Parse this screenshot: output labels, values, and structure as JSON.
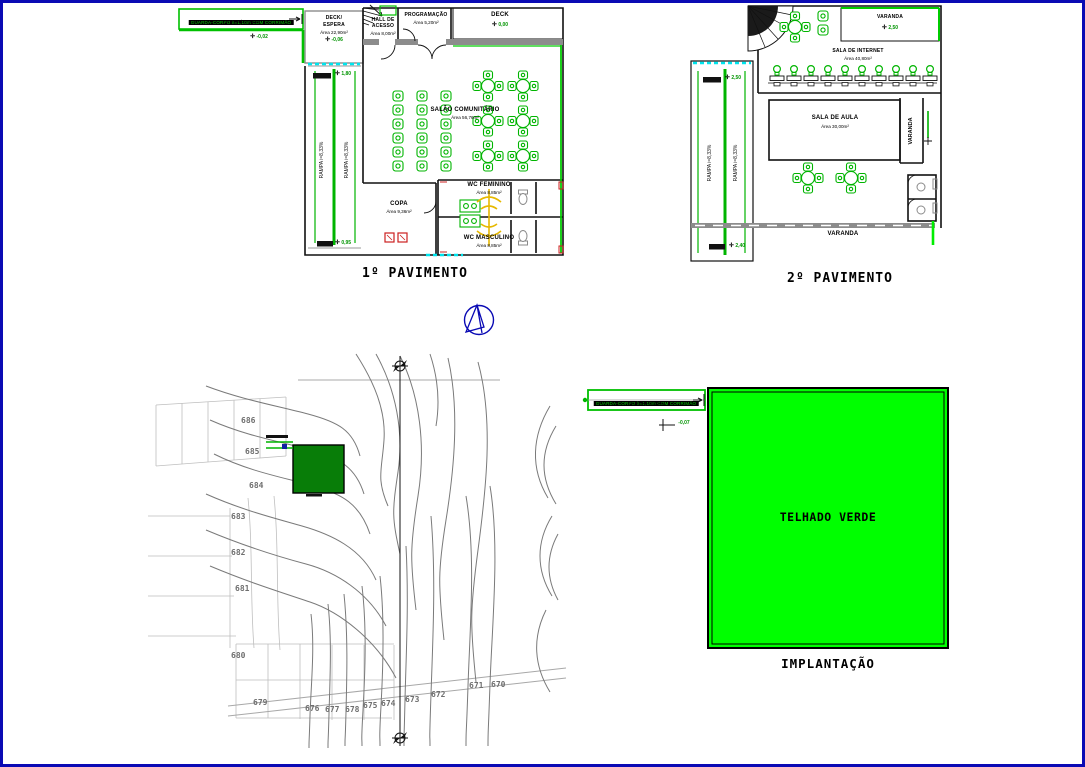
{
  "drawing": {
    "first_floor": {
      "title": "1º PAVIMENTO",
      "ramp": {
        "guard": "GUARDA-CORPO h=1,10m COM CORRIMÃO",
        "slope": "RAMPA i=8,33%",
        "entry_level": "-0,02"
      },
      "deck_espera": {
        "name1": "DECK/",
        "name2": "ESPERA",
        "area": "Área 22,90m²",
        "level": "-0,06"
      },
      "hall": {
        "name1": "HALL DE",
        "name2": "ACESSO",
        "area": "Área 8,00m²"
      },
      "programacao": {
        "name": "PROGRAMAÇÃO",
        "area": "Área 5,20m²"
      },
      "deck": {
        "name": "DECK",
        "level": "0,00"
      },
      "salao": {
        "name": "SALÃO COMUNITÁRIO",
        "area": "Área 56,76m²"
      },
      "copa": {
        "name": "COPA",
        "area": "Área 9,36m²"
      },
      "wc_feminino": {
        "name": "WC FEMININO",
        "area": "Área 8,85m²"
      },
      "wc_masculino": {
        "name": "WC MASCULINO",
        "area": "Área 8,85m²"
      },
      "ramp_interna": {
        "label": "RAMPA i=8,33%",
        "level_top": "1,80",
        "level_bottom": "0,95"
      }
    },
    "second_floor": {
      "title": "2º PAVIMENTO",
      "varanda_top": {
        "name": "VARANDA",
        "level": "2,50"
      },
      "sala_internet": {
        "name": "SALA DE INTERNET",
        "area": "Área 40,80m²"
      },
      "sala_aula": {
        "name": "SALA DE AULA",
        "area": "Área 30,00m²"
      },
      "varanda_right": {
        "name": "VARANDA"
      },
      "varanda_bottom": {
        "name": "VARANDA"
      },
      "ramp_interna": {
        "label": "RAMPA i=8,33%",
        "level_top": "2,50",
        "level_bottom": "2,40"
      }
    },
    "site_plan": {
      "contour_labels": [
        "686",
        "685",
        "684",
        "683",
        "682",
        "681",
        "680",
        "679",
        "676",
        "677",
        "678",
        "675",
        "674",
        "673",
        "672",
        "671",
        "670"
      ]
    },
    "implantacao": {
      "title": "IMPLANTAÇÃO",
      "roof_label": "TELHADO VERDE",
      "ramp": {
        "guard": "GUARDA-CORPO h=1,10m COM CORRIMÃO",
        "slope": "RAMPA i=8,33%",
        "level": "-0,07"
      }
    },
    "icons": {
      "level_marker": "✛"
    },
    "colors": {
      "frame": "#0a0ab4",
      "cad_green": "#00b400",
      "bright_green": "#00ff00",
      "site_green": "#087d08",
      "cyan": "#00e5ee",
      "wall_gray": "#8c8c8c",
      "fixture_yellow": "#e6b800",
      "accent_red": "#cc2020",
      "contour_gray": "#7a7a7a"
    }
  }
}
